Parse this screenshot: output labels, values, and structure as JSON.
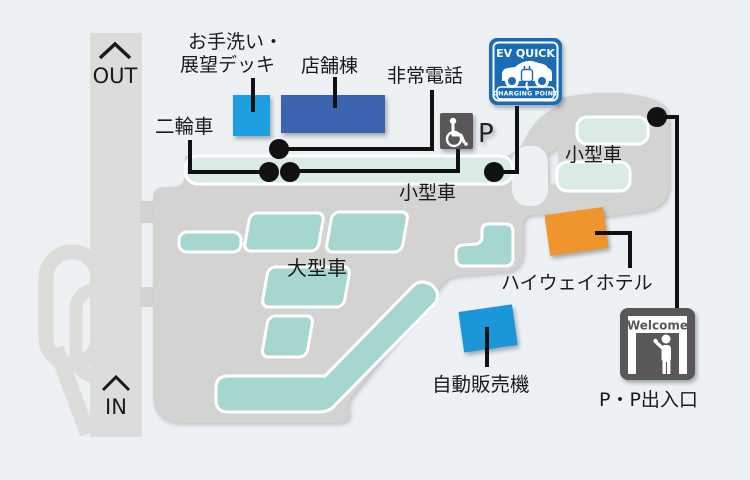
{
  "road": {
    "out": "OUT",
    "in": "IN"
  },
  "areas": {
    "small_car_main": "小型車",
    "small_car_east": "小型車",
    "large_car": "大型車",
    "motorcycle": "二輪車"
  },
  "facilities": {
    "restroom_line1": "お手洗い・",
    "restroom_line2": "展望デッキ",
    "store": "店舗棟",
    "emergency_phone": "非常電話",
    "hotel": "ハイウェイホテル",
    "vending": "自動販売機",
    "gate": "P・P出入口",
    "accessible_parking": "P"
  },
  "signs": {
    "ev_quick": {
      "title": "EV QUICK",
      "subtitle": "CHARGING POINT"
    },
    "welcome": {
      "text": "Welcome"
    }
  },
  "colors": {
    "background": "#edf1f4",
    "lot_gray": "#d3d4d2",
    "road_gray": "#dcddda",
    "parking_pale_teal": "#d9eae7",
    "parking_teal": "#a6d6d0",
    "restroom_building_blue": "#1b9fe0",
    "store_building_navy": "#3c63ad",
    "vending_blue": "#1b96d8",
    "hotel_orange": "#f0952b",
    "ev_sign_blue": "#1a6db4",
    "sign_dark_gray": "#595757"
  }
}
